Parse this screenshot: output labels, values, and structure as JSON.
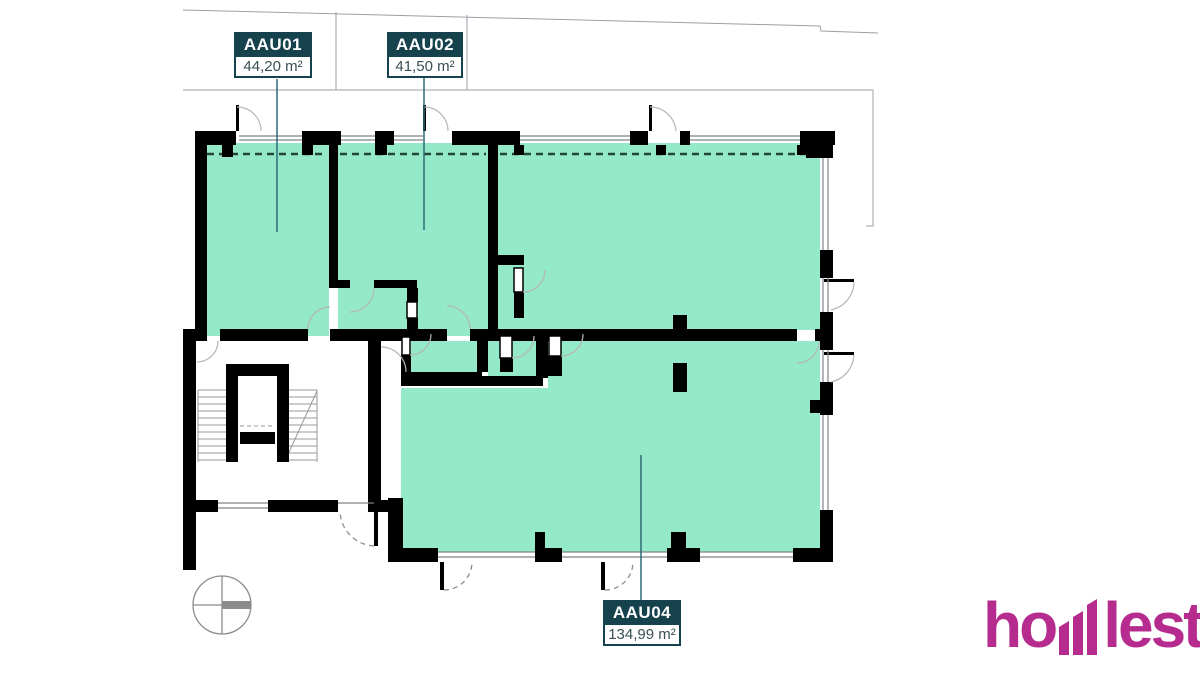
{
  "plan": {
    "units": [
      {
        "id": "AAU01",
        "area": "44,20 m²"
      },
      {
        "id": "AAU02",
        "area": "41,50 m²"
      },
      {
        "id": "AAU04",
        "area": "134,99 m²"
      }
    ]
  },
  "logo": {
    "text": "homest",
    "part_left": "ho",
    "part_right": "lest",
    "color": "#b62c8e"
  },
  "colors": {
    "room_fill": "#93E9C8",
    "wall": "#000000",
    "label_bg": "#16424e",
    "label_value_text": "#3a4e56",
    "leader_line": "#2f6b77",
    "boundary_dashed": "#25443c",
    "site_line": "#9aa0a6",
    "door_arc": "#b6b6b6",
    "compass": "#8c8c8c",
    "window_line": "#7d8488"
  }
}
